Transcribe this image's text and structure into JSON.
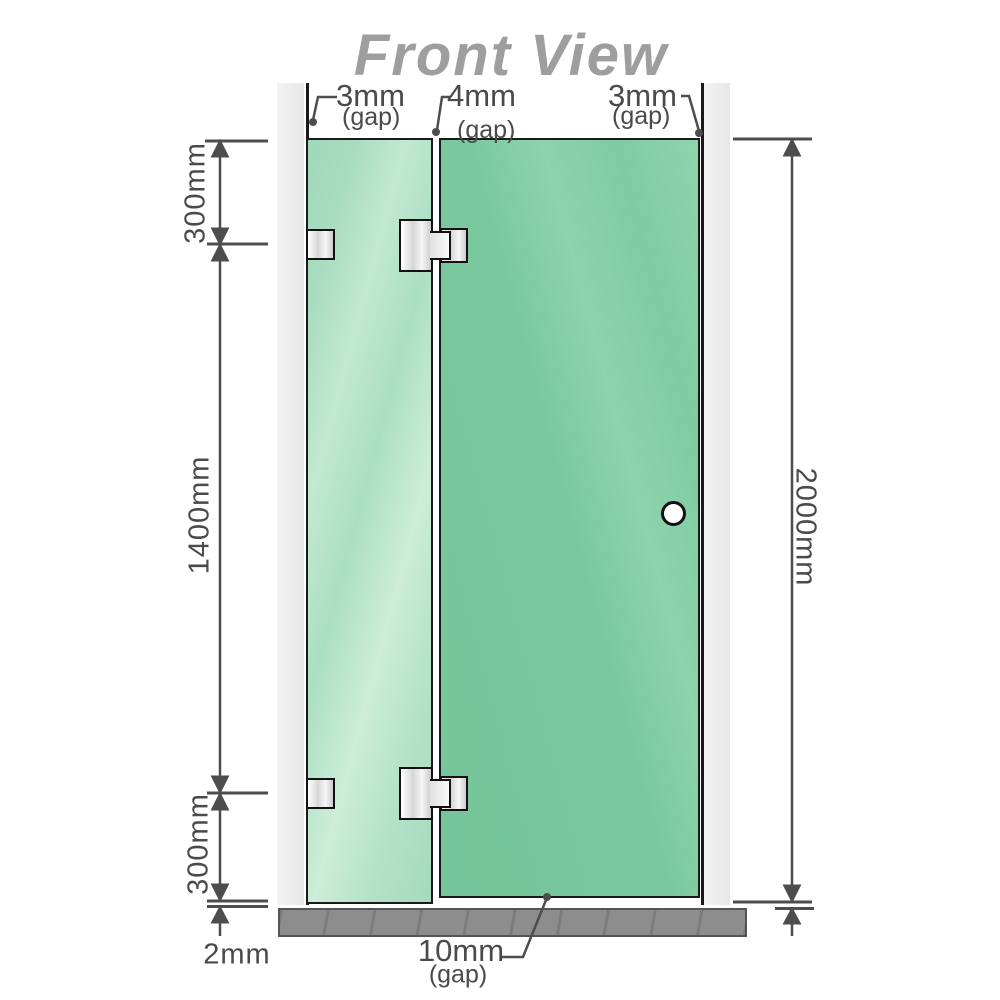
{
  "title": "Front View",
  "gap_labels": {
    "top_left": {
      "value": "3mm",
      "qualifier": "(gap)"
    },
    "top_middle": {
      "value": "4mm",
      "qualifier": "(gap)"
    },
    "top_right": {
      "value": "3mm",
      "qualifier": "(gap)"
    },
    "bottom": {
      "value": "10mm",
      "qualifier": "(gap)"
    }
  },
  "dimension_labels": {
    "left_top_segment": "300mm",
    "left_middle_segment": "1400mm",
    "left_bottom_segment": "300mm",
    "floor_clearance": "2mm",
    "right_total_height": "2000mm"
  },
  "colors": {
    "title_text": "#9e9e9e",
    "dimension_lines": "#4d4d4d",
    "fixed_panel_glass": "#aedfc3",
    "door_panel_glass": "#7cc9a0",
    "wall_profile": "#ececec",
    "floor": "#8d8d8d",
    "hardware_metal": "#e6e6e6",
    "outline": "#1a1a1a"
  },
  "components": {
    "walls": [
      "left-wall-profile",
      "right-wall-profile"
    ],
    "panels": [
      "fixed-glass-panel",
      "hinged-glass-door"
    ],
    "hinges": [
      "glass-to-glass-hinge-top",
      "glass-to-glass-hinge-bottom"
    ],
    "wall_brackets": [
      "wall-bracket-top",
      "wall-bracket-bottom"
    ],
    "knob": "door-knob",
    "floor": "floor-base"
  }
}
